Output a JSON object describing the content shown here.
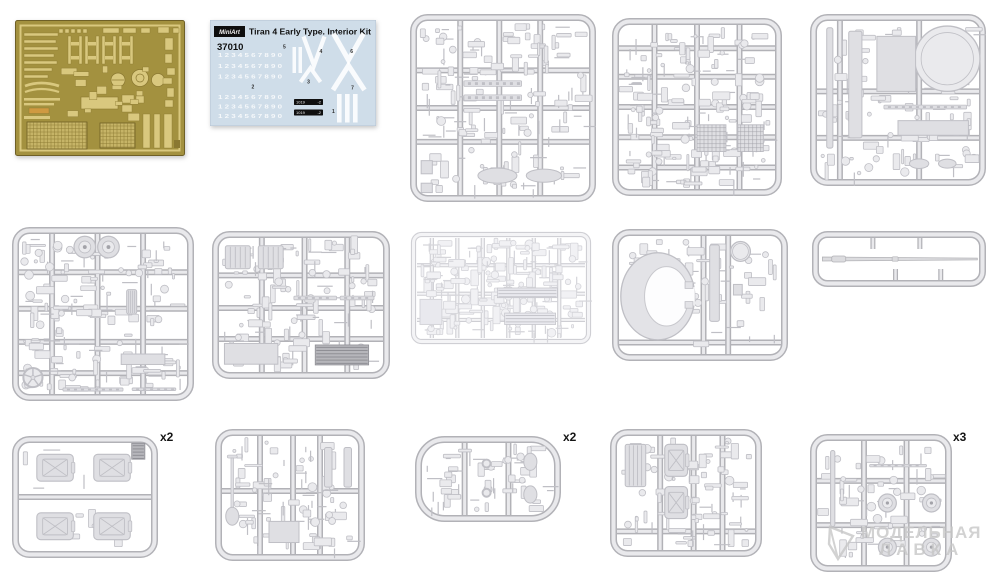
{
  "colors": {
    "pe_bg": "#a3913f",
    "pe_part": "#d9c87e",
    "pe_part_dark": "#8a7831",
    "pe_mesh": "#c6b467",
    "pe_accent": "#cf9a41",
    "pe_edge": "#6f6026",
    "sprue_edge": "#b2b2b7",
    "sprue_tube": "#e9e9ec",
    "label_color": "#151515",
    "watermark_color": "#c7c7c7",
    "decal_bg": "#cfdde9"
  },
  "watermark": {
    "line1": "МОДЕЛЬНАЯ",
    "line2": "ЛАВКА"
  },
  "decal": {
    "brand": "MiniArt",
    "title": "Tiran 4 Early Type. Interior Kit",
    "number": "37010",
    "digits": "1 2 3 4 5 6 7 8 9 0",
    "digit_rows": [
      0.33,
      0.435,
      0.535,
      0.725,
      0.815,
      0.905
    ],
    "labels": [
      {
        "text": "5",
        "x": 0.44,
        "y": 0.27
      },
      {
        "text": "4",
        "x": 0.66,
        "y": 0.31
      },
      {
        "text": "6",
        "x": 0.845,
        "y": 0.31
      },
      {
        "text": "3",
        "x": 0.585,
        "y": 0.6
      },
      {
        "text": "7",
        "x": 0.85,
        "y": 0.655
      },
      {
        "text": "2",
        "x": 0.25,
        "y": 0.645
      },
      {
        "text": "1",
        "x": 0.735,
        "y": 0.875
      }
    ],
    "plaques": [
      {
        "text": "1019",
        "mark": "-2"
      },
      {
        "text": "1019",
        "mark": "-2"
      }
    ],
    "bg": "#cfdde9"
  },
  "items": [
    {
      "name": "pe-fret",
      "kind": "pe",
      "x": 15,
      "y": 20,
      "w": 170,
      "h": 136
    },
    {
      "name": "decal-sheet",
      "kind": "decal",
      "x": 210,
      "y": 20,
      "w": 166,
      "h": 106
    },
    {
      "name": "sprue-large-1",
      "kind": "sprue",
      "x": 410,
      "y": 14,
      "w": 186,
      "h": 188,
      "seed": 11,
      "density": 150,
      "hbars": [
        0.3,
        0.5,
        0.68
      ],
      "vbars": [
        0.27,
        0.48,
        0.7
      ],
      "features": [
        {
          "t": "rail",
          "x": 0.29,
          "y": 0.355,
          "w": 0.31,
          "h": 0.03
        },
        {
          "t": "rail",
          "x": 0.29,
          "y": 0.43,
          "w": 0.31,
          "h": 0.03
        },
        {
          "t": "ellipse",
          "cx": 0.47,
          "cy": 0.86,
          "rx": 0.105,
          "ry": 0.04
        },
        {
          "t": "ellipse",
          "cx": 0.72,
          "cy": 0.86,
          "rx": 0.095,
          "ry": 0.035
        },
        {
          "t": "panel",
          "x": 0.06,
          "y": 0.78,
          "w": 0.06,
          "h": 0.07
        },
        {
          "t": "panel",
          "x": 0.06,
          "y": 0.9,
          "w": 0.06,
          "h": 0.05
        }
      ]
    },
    {
      "name": "sprue-large-2",
      "kind": "sprue",
      "x": 612,
      "y": 18,
      "w": 170,
      "h": 178,
      "seed": 22,
      "density": 170,
      "hbars": [
        0.17,
        0.33,
        0.5,
        0.67,
        0.84
      ],
      "vbars": [
        0.25,
        0.5,
        0.75
      ],
      "features": [
        {
          "t": "mesh",
          "x": 0.5,
          "y": 0.6,
          "w": 0.17,
          "h": 0.15
        },
        {
          "t": "mesh",
          "x": 0.74,
          "y": 0.6,
          "w": 0.15,
          "h": 0.15
        }
      ]
    },
    {
      "name": "sprue-large-3",
      "kind": "sprue",
      "x": 810,
      "y": 14,
      "w": 176,
      "h": 172,
      "seed": 33,
      "density": 110,
      "hbars": [
        0.45,
        0.72
      ],
      "vbars": [
        0.17,
        0.62
      ],
      "features": [
        {
          "t": "circle",
          "cx": 0.78,
          "cy": 0.26,
          "r": 0.19
        },
        {
          "t": "blade",
          "x": 0.095,
          "y": 0.08,
          "w": 0.035,
          "h": 0.7
        },
        {
          "t": "blade",
          "x": 0.22,
          "y": 0.1,
          "w": 0.075,
          "h": 0.62
        },
        {
          "t": "panel",
          "x": 0.38,
          "y": 0.13,
          "w": 0.22,
          "h": 0.32
        },
        {
          "t": "rail",
          "x": 0.42,
          "y": 0.53,
          "w": 0.47,
          "h": 0.022
        },
        {
          "t": "panel",
          "x": 0.5,
          "y": 0.62,
          "w": 0.4,
          "h": 0.085
        },
        {
          "t": "ellipse",
          "cx": 0.62,
          "cy": 0.87,
          "rx": 0.055,
          "ry": 0.028
        },
        {
          "t": "ellipse",
          "cx": 0.78,
          "cy": 0.87,
          "rx": 0.05,
          "ry": 0.026
        }
      ]
    },
    {
      "name": "sprue-large-4",
      "kind": "sprue",
      "x": 12,
      "y": 227,
      "w": 182,
      "h": 174,
      "seed": 44,
      "density": 150,
      "hbars": [
        0.26,
        0.47,
        0.66,
        0.84
      ],
      "vbars": [
        0.22,
        0.47,
        0.72
      ],
      "features": [
        {
          "t": "wheel",
          "cx": 0.4,
          "cy": 0.115,
          "r": 0.062
        },
        {
          "t": "wheel",
          "cx": 0.53,
          "cy": 0.115,
          "r": 0.062
        },
        {
          "t": "spoked",
          "cx": 0.115,
          "cy": 0.865,
          "r": 0.055
        },
        {
          "t": "rail",
          "x": 0.28,
          "y": 0.925,
          "w": 0.33,
          "h": 0.018
        },
        {
          "t": "rail",
          "x": 0.66,
          "y": 0.925,
          "w": 0.24,
          "h": 0.015
        },
        {
          "t": "panel",
          "x": 0.6,
          "y": 0.73,
          "w": 0.24,
          "h": 0.06
        },
        {
          "t": "drum",
          "x": 0.63,
          "y": 0.36,
          "w": 0.055,
          "h": 0.14
        }
      ]
    },
    {
      "name": "sprue-large-5",
      "kind": "sprue",
      "x": 212,
      "y": 231,
      "w": 178,
      "h": 148,
      "seed": 55,
      "density": 120,
      "hbars": [
        0.3,
        0.52,
        0.73
      ],
      "vbars": [
        0.28,
        0.52,
        0.76
      ],
      "features": [
        {
          "t": "drum",
          "x": 0.075,
          "y": 0.1,
          "w": 0.14,
          "h": 0.155
        },
        {
          "t": "drum",
          "x": 0.26,
          "y": 0.1,
          "w": 0.14,
          "h": 0.155
        },
        {
          "t": "grille",
          "x": 0.58,
          "y": 0.77,
          "w": 0.3,
          "h": 0.135
        },
        {
          "t": "panel",
          "x": 0.07,
          "y": 0.76,
          "w": 0.3,
          "h": 0.14
        },
        {
          "t": "rail",
          "x": 0.46,
          "y": 0.44,
          "w": 0.24,
          "h": 0.025
        },
        {
          "t": "rail",
          "x": 0.72,
          "y": 0.44,
          "w": 0.19,
          "h": 0.025
        }
      ]
    },
    {
      "name": "sprue-flat-light",
      "kind": "sprue",
      "tone": "light",
      "x": 410,
      "y": 231,
      "w": 182,
      "h": 114,
      "seed": 66,
      "density": 210,
      "rx": 8,
      "hbars": [
        0.3,
        0.55,
        0.78
      ],
      "vbars": [
        0.12,
        0.26,
        0.4,
        0.54,
        0.68,
        0.82
      ],
      "features": [
        {
          "t": "grille",
          "x": 0.48,
          "y": 0.5,
          "w": 0.33,
          "h": 0.085,
          "light": true
        },
        {
          "t": "grille",
          "x": 0.52,
          "y": 0.72,
          "w": 0.28,
          "h": 0.1,
          "light": true
        },
        {
          "t": "panel",
          "x": 0.055,
          "y": 0.6,
          "w": 0.12,
          "h": 0.22
        }
      ]
    },
    {
      "name": "sprue-turret",
      "kind": "sprue",
      "x": 612,
      "y": 229,
      "w": 176,
      "h": 132,
      "seed": 77,
      "density": 60,
      "hbars": [
        0.86
      ],
      "vbars": [
        0.52,
        0.66
      ],
      "features": [
        {
          "t": "turret"
        },
        {
          "t": "blade",
          "x": 0.555,
          "y": 0.12,
          "w": 0.055,
          "h": 0.58
        },
        {
          "t": "circle",
          "cx": 0.73,
          "cy": 0.17,
          "r": 0.075
        },
        {
          "t": "panel",
          "x": 0.69,
          "y": 0.42,
          "w": 0.05,
          "h": 0.08
        }
      ]
    },
    {
      "name": "sprue-gun-barrel",
      "kind": "sprue",
      "x": 812,
      "y": 231,
      "w": 174,
      "h": 56,
      "seed": 88,
      "density": 0,
      "rx": 12,
      "hbars": [],
      "vbars": [],
      "features": [
        {
          "t": "barrel",
          "x1": 0.06,
          "y": 0.5,
          "x2": 0.95
        },
        {
          "t": "stub",
          "x": 0.35,
          "y": 0.18
        },
        {
          "t": "stub",
          "x": 0.62,
          "y": 0.18
        },
        {
          "t": "stub",
          "x": 0.48,
          "y": 0.78
        },
        {
          "t": "stub",
          "x": 0.74,
          "y": 0.78
        }
      ]
    },
    {
      "name": "sprue-fuel-cans",
      "kind": "sprue",
      "x": 12,
      "y": 436,
      "w": 146,
      "h": 122,
      "seed": 99,
      "density": 16,
      "label": "x2",
      "label_x": 160,
      "label_y": 430,
      "hbars": [
        0.5
      ],
      "vbars": [],
      "features": [
        {
          "t": "can",
          "x": 0.17,
          "y": 0.15,
          "w": 0.25,
          "h": 0.22
        },
        {
          "t": "can",
          "x": 0.56,
          "y": 0.15,
          "w": 0.25,
          "h": 0.22
        },
        {
          "t": "can",
          "x": 0.17,
          "y": 0.63,
          "w": 0.25,
          "h": 0.22
        },
        {
          "t": "can",
          "x": 0.56,
          "y": 0.63,
          "w": 0.25,
          "h": 0.22
        },
        {
          "t": "grille",
          "x": 0.82,
          "y": 0.06,
          "w": 0.09,
          "h": 0.13
        }
      ]
    },
    {
      "name": "sprue-tools",
      "kind": "sprue",
      "x": 215,
      "y": 429,
      "w": 150,
      "h": 132,
      "seed": 110,
      "density": 85,
      "hbars": [
        0.47
      ],
      "vbars": [
        0.3,
        0.52,
        0.7
      ],
      "features": [
        {
          "t": "shovel",
          "cx": 0.115,
          "cy": 0.52
        },
        {
          "t": "blade",
          "x": 0.73,
          "y": 0.14,
          "w": 0.05,
          "h": 0.3
        },
        {
          "t": "blade",
          "x": 0.86,
          "y": 0.14,
          "w": 0.05,
          "h": 0.3
        },
        {
          "t": "panel",
          "x": 0.36,
          "y": 0.7,
          "w": 0.2,
          "h": 0.16
        }
      ]
    },
    {
      "name": "sprue-small-wide",
      "kind": "sprue",
      "x": 415,
      "y": 436,
      "w": 146,
      "h": 86,
      "seed": 121,
      "density": 55,
      "rx": 26,
      "label": "x2",
      "label_x": 563,
      "label_y": 430,
      "hbars": [],
      "vbars": [
        0.34,
        0.64
      ],
      "features": [
        {
          "t": "ellipse",
          "cx": 0.79,
          "cy": 0.3,
          "rx": 0.045,
          "ry": 0.1
        },
        {
          "t": "ellipse",
          "cx": 0.79,
          "cy": 0.68,
          "rx": 0.045,
          "ry": 0.1
        },
        {
          "t": "circle",
          "cx": 0.49,
          "cy": 0.32,
          "r": 0.05
        },
        {
          "t": "circle",
          "cx": 0.49,
          "cy": 0.66,
          "r": 0.05
        }
      ]
    },
    {
      "name": "sprue-brackets",
      "kind": "sprue",
      "x": 610,
      "y": 429,
      "w": 152,
      "h": 128,
      "seed": 132,
      "density": 75,
      "hbars": [
        0.8
      ],
      "vbars": [
        0.33,
        0.55,
        0.74
      ],
      "features": [
        {
          "t": "can",
          "x": 0.36,
          "y": 0.12,
          "w": 0.15,
          "h": 0.25
        },
        {
          "t": "can",
          "x": 0.36,
          "y": 0.45,
          "w": 0.15,
          "h": 0.25
        },
        {
          "t": "drum",
          "x": 0.1,
          "y": 0.12,
          "w": 0.135,
          "h": 0.33
        }
      ]
    },
    {
      "name": "sprue-wheels",
      "kind": "sprue",
      "x": 810,
      "y": 434,
      "w": 142,
      "h": 138,
      "seed": 143,
      "density": 60,
      "label": "x3",
      "label_x": 953,
      "label_y": 430,
      "hbars": [
        0.34,
        0.66
      ],
      "vbars": [
        0.38,
        0.68
      ],
      "features": [
        {
          "t": "wheel",
          "cx": 0.545,
          "cy": 0.5,
          "r": 0.065
        },
        {
          "t": "wheel",
          "cx": 0.855,
          "cy": 0.5,
          "r": 0.065
        },
        {
          "t": "wheel",
          "cx": 0.545,
          "cy": 0.82,
          "r": 0.065
        },
        {
          "t": "wheel",
          "cx": 0.855,
          "cy": 0.82,
          "r": 0.065
        },
        {
          "t": "blade",
          "x": 0.145,
          "y": 0.12,
          "w": 0.03,
          "h": 0.55
        },
        {
          "t": "rail",
          "x": 0.42,
          "y": 0.22,
          "w": 0.4,
          "h": 0.018
        }
      ]
    }
  ]
}
